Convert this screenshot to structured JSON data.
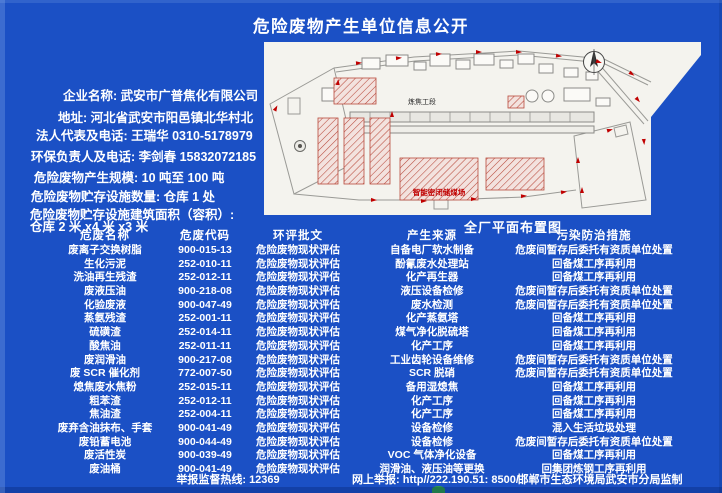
{
  "page": {
    "title": "危险废物产生单位信息公开",
    "colors": {
      "background": "#1b50c5",
      "text": "#ffffff",
      "map_paper": "#f4f3ee",
      "map_red": "#c00000"
    }
  },
  "info": {
    "lines": [
      "企业名称: 武安市广普焦化有限公司",
      "地址: 河北省武安市阳邑镇北华村北",
      "法人代表及电话: 王瑞华 0310-5178979",
      "环保负责人及电话: 李剑春 15832072185",
      "危险废物产生规模: 10 吨至 100 吨",
      "危险废物贮存设施数量: 仓库 1 处",
      "危险废物贮存设施建筑面积（容积）:",
      "仓库 2 米 x4 米 x3 米"
    ]
  },
  "map": {
    "caption": "全厂平面布置图",
    "labels": {
      "coking_section": "炼焦工段",
      "coal_shed": "智能密闭储煤场"
    },
    "icons": [
      "north-arrow-icon"
    ]
  },
  "table": {
    "headers": [
      "危废名称",
      "危废代码",
      "环评批文",
      "产生来源",
      "污染防治措施"
    ],
    "rows": [
      [
        "废离子交换树脂",
        "900-015-13",
        "危险废物现状评估",
        "自备电厂软水制备",
        "危废间暂存后委托有资质单位处置"
      ],
      [
        "生化污泥",
        "252-010-11",
        "危险废物现状评估",
        "酚氰废水处理站",
        "回备煤工序再利用"
      ],
      [
        "洗油再生残渣",
        "252-012-11",
        "危险废物现状评估",
        "化产再生器",
        "回备煤工序再利用"
      ],
      [
        "废液压油",
        "900-218-08",
        "危险废物现状评估",
        "液压设备检修",
        "危废间暂存后委托有资质单位处置"
      ],
      [
        "化验废液",
        "900-047-49",
        "危险废物现状评估",
        "废水检测",
        "危废间暂存后委托有资质单位处置"
      ],
      [
        "蒸氨残渣",
        "252-001-11",
        "危险废物现状评估",
        "化产蒸氨塔",
        "回备煤工序再利用"
      ],
      [
        "硫磺渣",
        "252-014-11",
        "危险废物现状评估",
        "煤气净化脱硫塔",
        "回备煤工序再利用"
      ],
      [
        "酸焦油",
        "252-011-11",
        "危险废物现状评估",
        "化产工序",
        "回备煤工序再利用"
      ],
      [
        "废润滑油",
        "900-217-08",
        "危险废物现状评估",
        "工业齿轮设备维修",
        "危废间暂存后委托有资质单位处置"
      ],
      [
        "废 SCR 催化剂",
        "772-007-50",
        "危险废物现状评估",
        "SCR 脱硝",
        "危废间暂存后委托有资质单位处置"
      ],
      [
        "熄焦废水焦粉",
        "252-015-11",
        "危险废物现状评估",
        "备用湿熄焦",
        "回备煤工序再利用"
      ],
      [
        "粗苯渣",
        "252-012-11",
        "危险废物现状评估",
        "化产工序",
        "回备煤工序再利用"
      ],
      [
        "焦油渣",
        "252-004-11",
        "危险废物现状评估",
        "化产工序",
        "回备煤工序再利用"
      ],
      [
        "废弃含油抹布、手套",
        "900-041-49",
        "危险废物现状评估",
        "设备检修",
        "混入生活垃圾处理"
      ],
      [
        "废铅蓄电池",
        "900-044-49",
        "危险废物现状评估",
        "设备检修",
        "危废间暂存后委托有资质单位处置"
      ],
      [
        "废活性炭",
        "900-039-49",
        "危险废物现状评估",
        "VOC 气体净化设备",
        "回备煤工序再利用"
      ],
      [
        "废油桶",
        "900-041-49",
        "危险废物现状评估",
        "润滑油、液压油等更换",
        "回集团炼钢工序再利用"
      ]
    ]
  },
  "footer": {
    "hotline": "举报监督热线: 12369",
    "web_report": "网上举报: http//222.190.51: 8500/",
    "producer": "邯郸市生态环境局武安市分局监制"
  }
}
